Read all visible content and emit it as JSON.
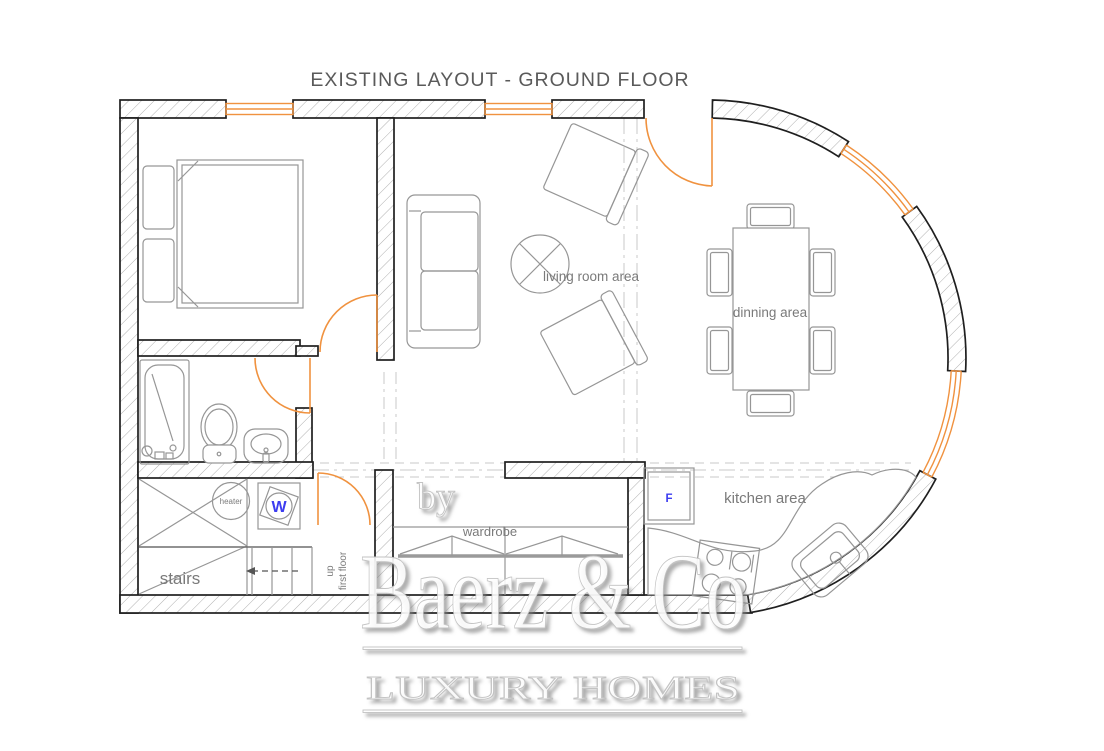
{
  "title": "EXISTING LAYOUT -  GROUND FLOOR",
  "labels": {
    "living_room": "living room area",
    "dining": "dinning area",
    "kitchen": "kitchen area",
    "wardrobe": "wardrobe",
    "stairs": "stairs",
    "heater": "heater",
    "up": "up",
    "first_floor": "first floor",
    "washer": "W",
    "fridge": "F"
  },
  "watermark": {
    "prefix": "by",
    "brand": "Baerz & Co",
    "tagline": "LUXURY HOMES"
  },
  "colors": {
    "accent_orange": "#F0923F",
    "appliance_blue": "#3C3CF0",
    "label_gray": "#7a7a7a",
    "wall_line": "#1f1f1f"
  }
}
